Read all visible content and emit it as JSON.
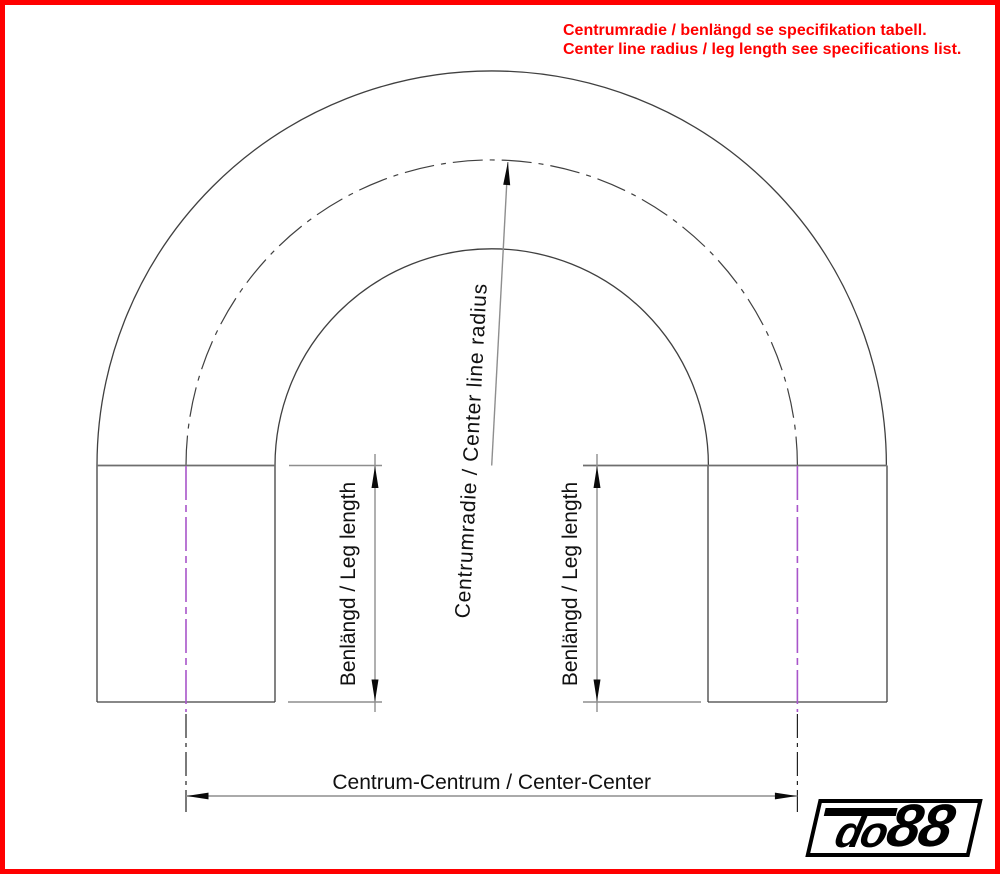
{
  "note": {
    "line1": "Centrumradie / benlängd se specifikation tabell.",
    "line2": "Center line radius / leg length see specifications list."
  },
  "dimension_labels": {
    "center_line_radius": "Centrumradie / Center line radius",
    "leg_length_left": "Benlängd / Leg length",
    "leg_length_right": "Benlängd / Leg length",
    "center_to_center": "Centrum-Centrum / Center-Center"
  },
  "logo": {
    "prefix": "do",
    "suffix": "88"
  },
  "colors": {
    "page_border": "#ff0000",
    "note_text": "#ff0000",
    "drawing_lines": "#404040",
    "tangent_lines": "#6e6e6e",
    "dimension_lines": "#8e8e8e",
    "arrowheads": "#0a0a0a",
    "leg_centerline": "#a855ca",
    "label_text": "#111111",
    "logo_frame": "#000000",
    "logo_background": "#ffffff",
    "logo_text": "#000000"
  }
}
